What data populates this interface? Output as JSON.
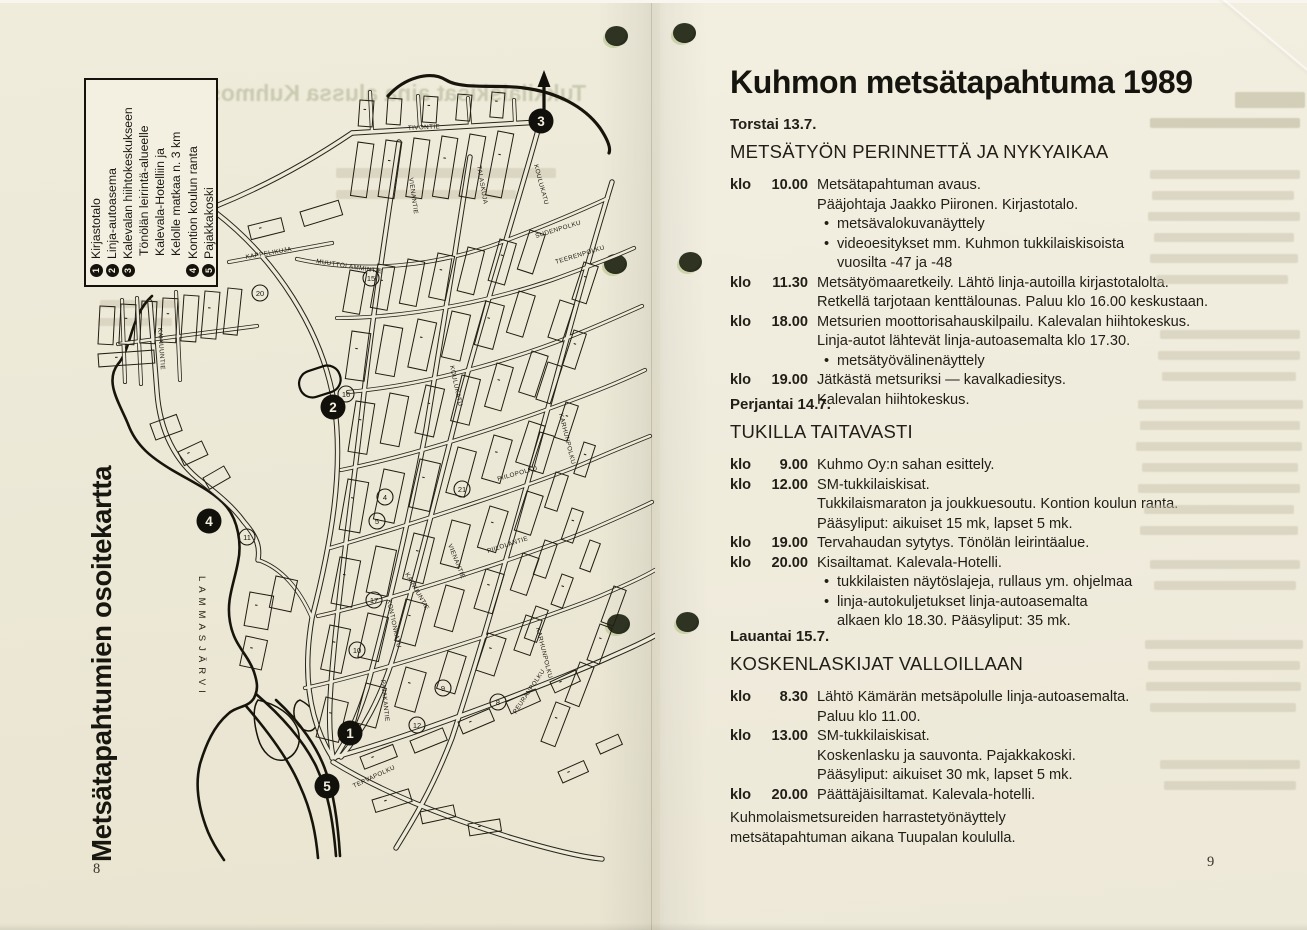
{
  "scan": {
    "page_left_number": "8",
    "page_right_number": "9"
  },
  "left_page": {
    "vertical_title": "Metsätapahtumien osoitekartta",
    "ghost_headline": "Tukkilaiskisat aina alussa Kuhmossa",
    "legend_rows": [
      {
        "num": "1",
        "text": "Kirjastotalo",
        "indent": false
      },
      {
        "num": "2",
        "text": "Linja-autoasema",
        "indent": false
      },
      {
        "num": "3",
        "text": "Kalevalan hiihtokeskukseen",
        "indent": false
      },
      {
        "num": "",
        "text": "Tönölän leirintä-alueelle",
        "indent": true
      },
      {
        "num": "",
        "text": "Kalevala-Hotelliin ja",
        "indent": true
      },
      {
        "num": "",
        "text": "Kelolle matkaa n. 3 km",
        "indent": true
      },
      {
        "num": "4",
        "text": "Kontion koulun ranta",
        "indent": false
      },
      {
        "num": "5",
        "text": "Pajakkakoski",
        "indent": false
      }
    ],
    "map": {
      "water_label": "LAMMASJÄRVI",
      "markers": [
        {
          "n": "1"
        },
        {
          "n": "2"
        },
        {
          "n": "3"
        },
        {
          "n": "4"
        },
        {
          "n": "5"
        }
      ],
      "streets": [
        "TIVONTIE",
        "KOULUKATU",
        "VIENANTIE",
        "TALASKUJA",
        "KAPPELIKUJA",
        "MUUTTOLAMMINTIE",
        "SUDENPOLKU",
        "TEERENPOLKU",
        "KARHUNPOLKU",
        "PIILOPOLKU",
        "PIILOLANTIE",
        "KAINUUNTIE",
        "KONTIONKATU",
        "PAJAKANTIE",
        "PEURANPOLKU",
        "TERVAPOLKU",
        "KOULUKATU",
        "VIENANTIE",
        "KAINUUNTIE",
        "KARHUNPOLKU"
      ],
      "poi_numbers": [
        "20",
        "15",
        "16",
        "11",
        "10",
        "17",
        "9",
        "8",
        "12",
        "5",
        "4",
        "21"
      ]
    }
  },
  "right_page": {
    "title": "Kuhmon metsätapahtuma 1989",
    "time_prefix": "klo",
    "days": [
      {
        "date": "Torstai 13.7.",
        "heading": "METSÄTYÖN PERINNETTÄ JA NYKYAIKAA",
        "events": [
          {
            "time": "10.00",
            "lines": [
              {
                "text": "Metsätapahtuman avaus.",
                "style": "plain"
              },
              {
                "text": "Pääjohtaja Jaakko Piironen. Kirjastotalo.",
                "style": "plain"
              },
              {
                "text": "metsävalokuvanäyttely",
                "style": "bullet"
              },
              {
                "text": "videoesitykset mm. Kuhmon tukkilaiskisoista",
                "style": "bullet"
              },
              {
                "text": "vuosilta -47 ja -48",
                "style": "cont"
              }
            ]
          },
          {
            "time": "11.30",
            "lines": [
              {
                "text": "Metsätyömaaretkeily. Lähtö linja-autoilla kirjastotalolta.",
                "style": "plain"
              },
              {
                "text": "Retkellä tarjotaan kenttälounas. Paluu klo 16.00 keskustaan.",
                "style": "plain"
              }
            ]
          },
          {
            "time": "18.00",
            "lines": [
              {
                "text": "Metsurien moottorisahauskilpailu. Kalevalan hiihtokeskus.",
                "style": "plain"
              },
              {
                "text": "Linja-autot lähtevät linja-autoasemalta klo 17.30.",
                "style": "plain"
              },
              {
                "text": "metsätyövälinenäyttely",
                "style": "bullet"
              }
            ]
          },
          {
            "time": "19.00",
            "lines": [
              {
                "text": "Jätkästä metsuriksi — kavalkadiesitys.",
                "style": "plain"
              },
              {
                "text": "Kalevalan hiihtokeskus.",
                "style": "plain"
              }
            ]
          }
        ]
      },
      {
        "date": "Perjantai 14.7.",
        "heading": "TUKILLA TAITAVASTI",
        "events": [
          {
            "time": "9.00",
            "lines": [
              {
                "text": "Kuhmo Oy:n sahan esittely.",
                "style": "plain"
              }
            ]
          },
          {
            "time": "12.00",
            "lines": [
              {
                "text": "SM-tukkilaiskisat.",
                "style": "plain"
              },
              {
                "text": "Tukkilaismaraton ja joukkuesoutu. Kontion koulun ranta.",
                "style": "plain"
              },
              {
                "text": "Pääsyliput: aikuiset 15 mk, lapset 5 mk.",
                "style": "plain"
              }
            ]
          },
          {
            "time": "19.00",
            "lines": [
              {
                "text": "Tervahaudan sytytys. Tönölän leirintäalue.",
                "style": "plain"
              }
            ]
          },
          {
            "time": "20.00",
            "lines": [
              {
                "text": "Kisailtamat. Kalevala-Hotelli.",
                "style": "plain"
              },
              {
                "text": "tukkilaisten näytöslajeja, rullaus ym. ohjelmaa",
                "style": "bullet"
              },
              {
                "text": "linja-autokuljetukset linja-autoasemalta",
                "style": "bullet"
              },
              {
                "text": "alkaen klo 18.30. Pääsyliput: 35 mk.",
                "style": "cont"
              }
            ]
          }
        ]
      },
      {
        "date": "Lauantai 15.7.",
        "heading": "KOSKENLASKIJAT VALLOILLAAN",
        "events": [
          {
            "time": "8.30",
            "lines": [
              {
                "text": "Lähtö Kämärän metsäpolulle linja-autoasemalta.",
                "style": "plain"
              },
              {
                "text": "Paluu klo 11.00.",
                "style": "plain"
              }
            ]
          },
          {
            "time": "13.00",
            "lines": [
              {
                "text": "SM-tukkilaiskisat.",
                "style": "plain"
              },
              {
                "text": "Koskenlasku ja sauvonta. Pajakkakoski.",
                "style": "plain"
              },
              {
                "text": "Pääsyliput: aikuiset 30 mk, lapset 5 mk.",
                "style": "plain"
              }
            ]
          },
          {
            "time": "20.00",
            "lines": [
              {
                "text": "Päättäjäisiltamat. Kalevala-hotelli.",
                "style": "plain"
              }
            ]
          }
        ]
      }
    ],
    "footer_lines": [
      "Kuhmolaismetsureiden harrastetyönäyttely",
      "metsätapahtuman aikana Tuupalan koululla."
    ]
  }
}
